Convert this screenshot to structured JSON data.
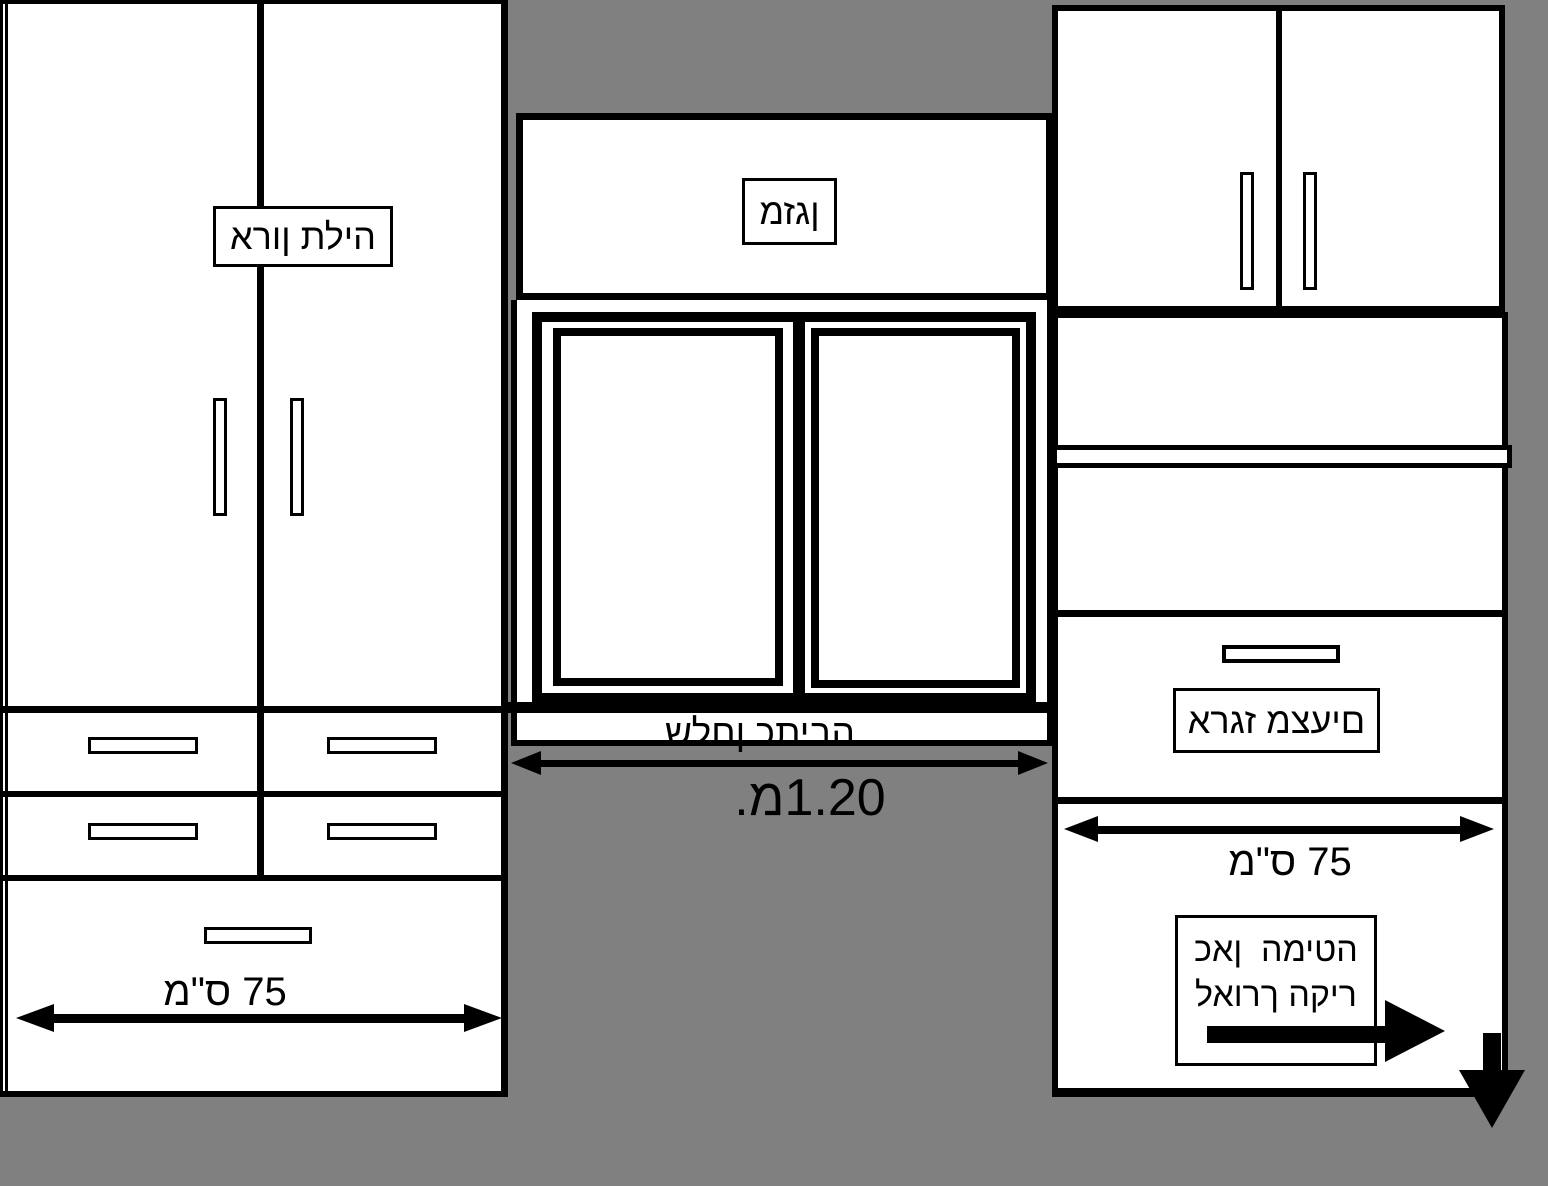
{
  "diagram": {
    "background_color": "#808080",
    "outline_color": "#000000",
    "surface_color": "#ffffff"
  },
  "wardrobe": {
    "label": "ארון תליה",
    "width_label": "מ\"ס 75"
  },
  "desk_area": {
    "ac_label": "מזגן",
    "desk_label": "שלחן כתיבה",
    "width_label": ".מ1.20"
  },
  "linen_unit": {
    "label": "ארגז מצעים",
    "width_label": "מ\"ס 75",
    "note_line1": "כאן  המיטה",
    "note_line2": "לאורך הקיר"
  }
}
